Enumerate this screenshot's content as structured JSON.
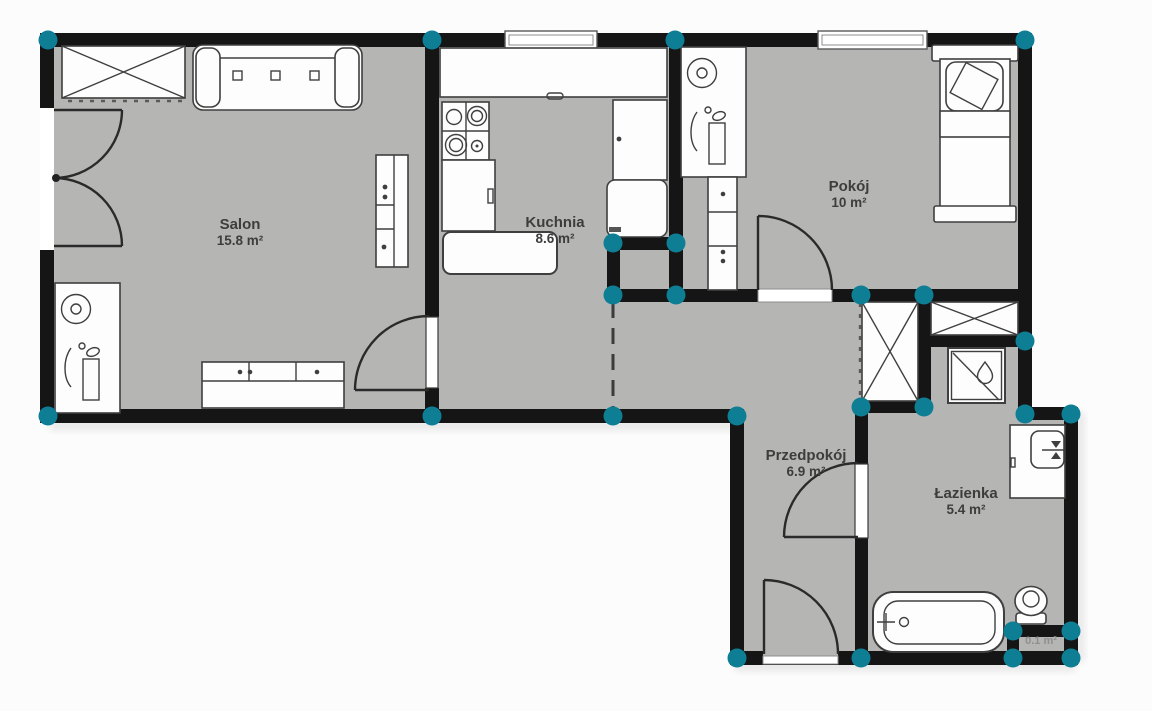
{
  "plan": {
    "rooms": [
      {
        "id": "salon",
        "name": "Salon",
        "area": "15.8 m²"
      },
      {
        "id": "kuchnia",
        "name": "Kuchnia",
        "area": "8.6 m²"
      },
      {
        "id": "pokoj",
        "name": "Pokój",
        "area": "10 m²"
      },
      {
        "id": "przedpokoj",
        "name": "Przedpokój",
        "area": "6.9 m²"
      },
      {
        "id": "lazienka",
        "name": "Łazienka",
        "area": "5.4 m²"
      },
      {
        "id": "schowek",
        "name": "",
        "area": "0.1 m²"
      }
    ],
    "colors": {
      "wall": "#151515",
      "floor": "#b5b5b4",
      "marker": "#0e7e95",
      "bg": "#fcfcfc",
      "stroke": "#3f3f3f",
      "label": "#3d3d3d"
    }
  }
}
